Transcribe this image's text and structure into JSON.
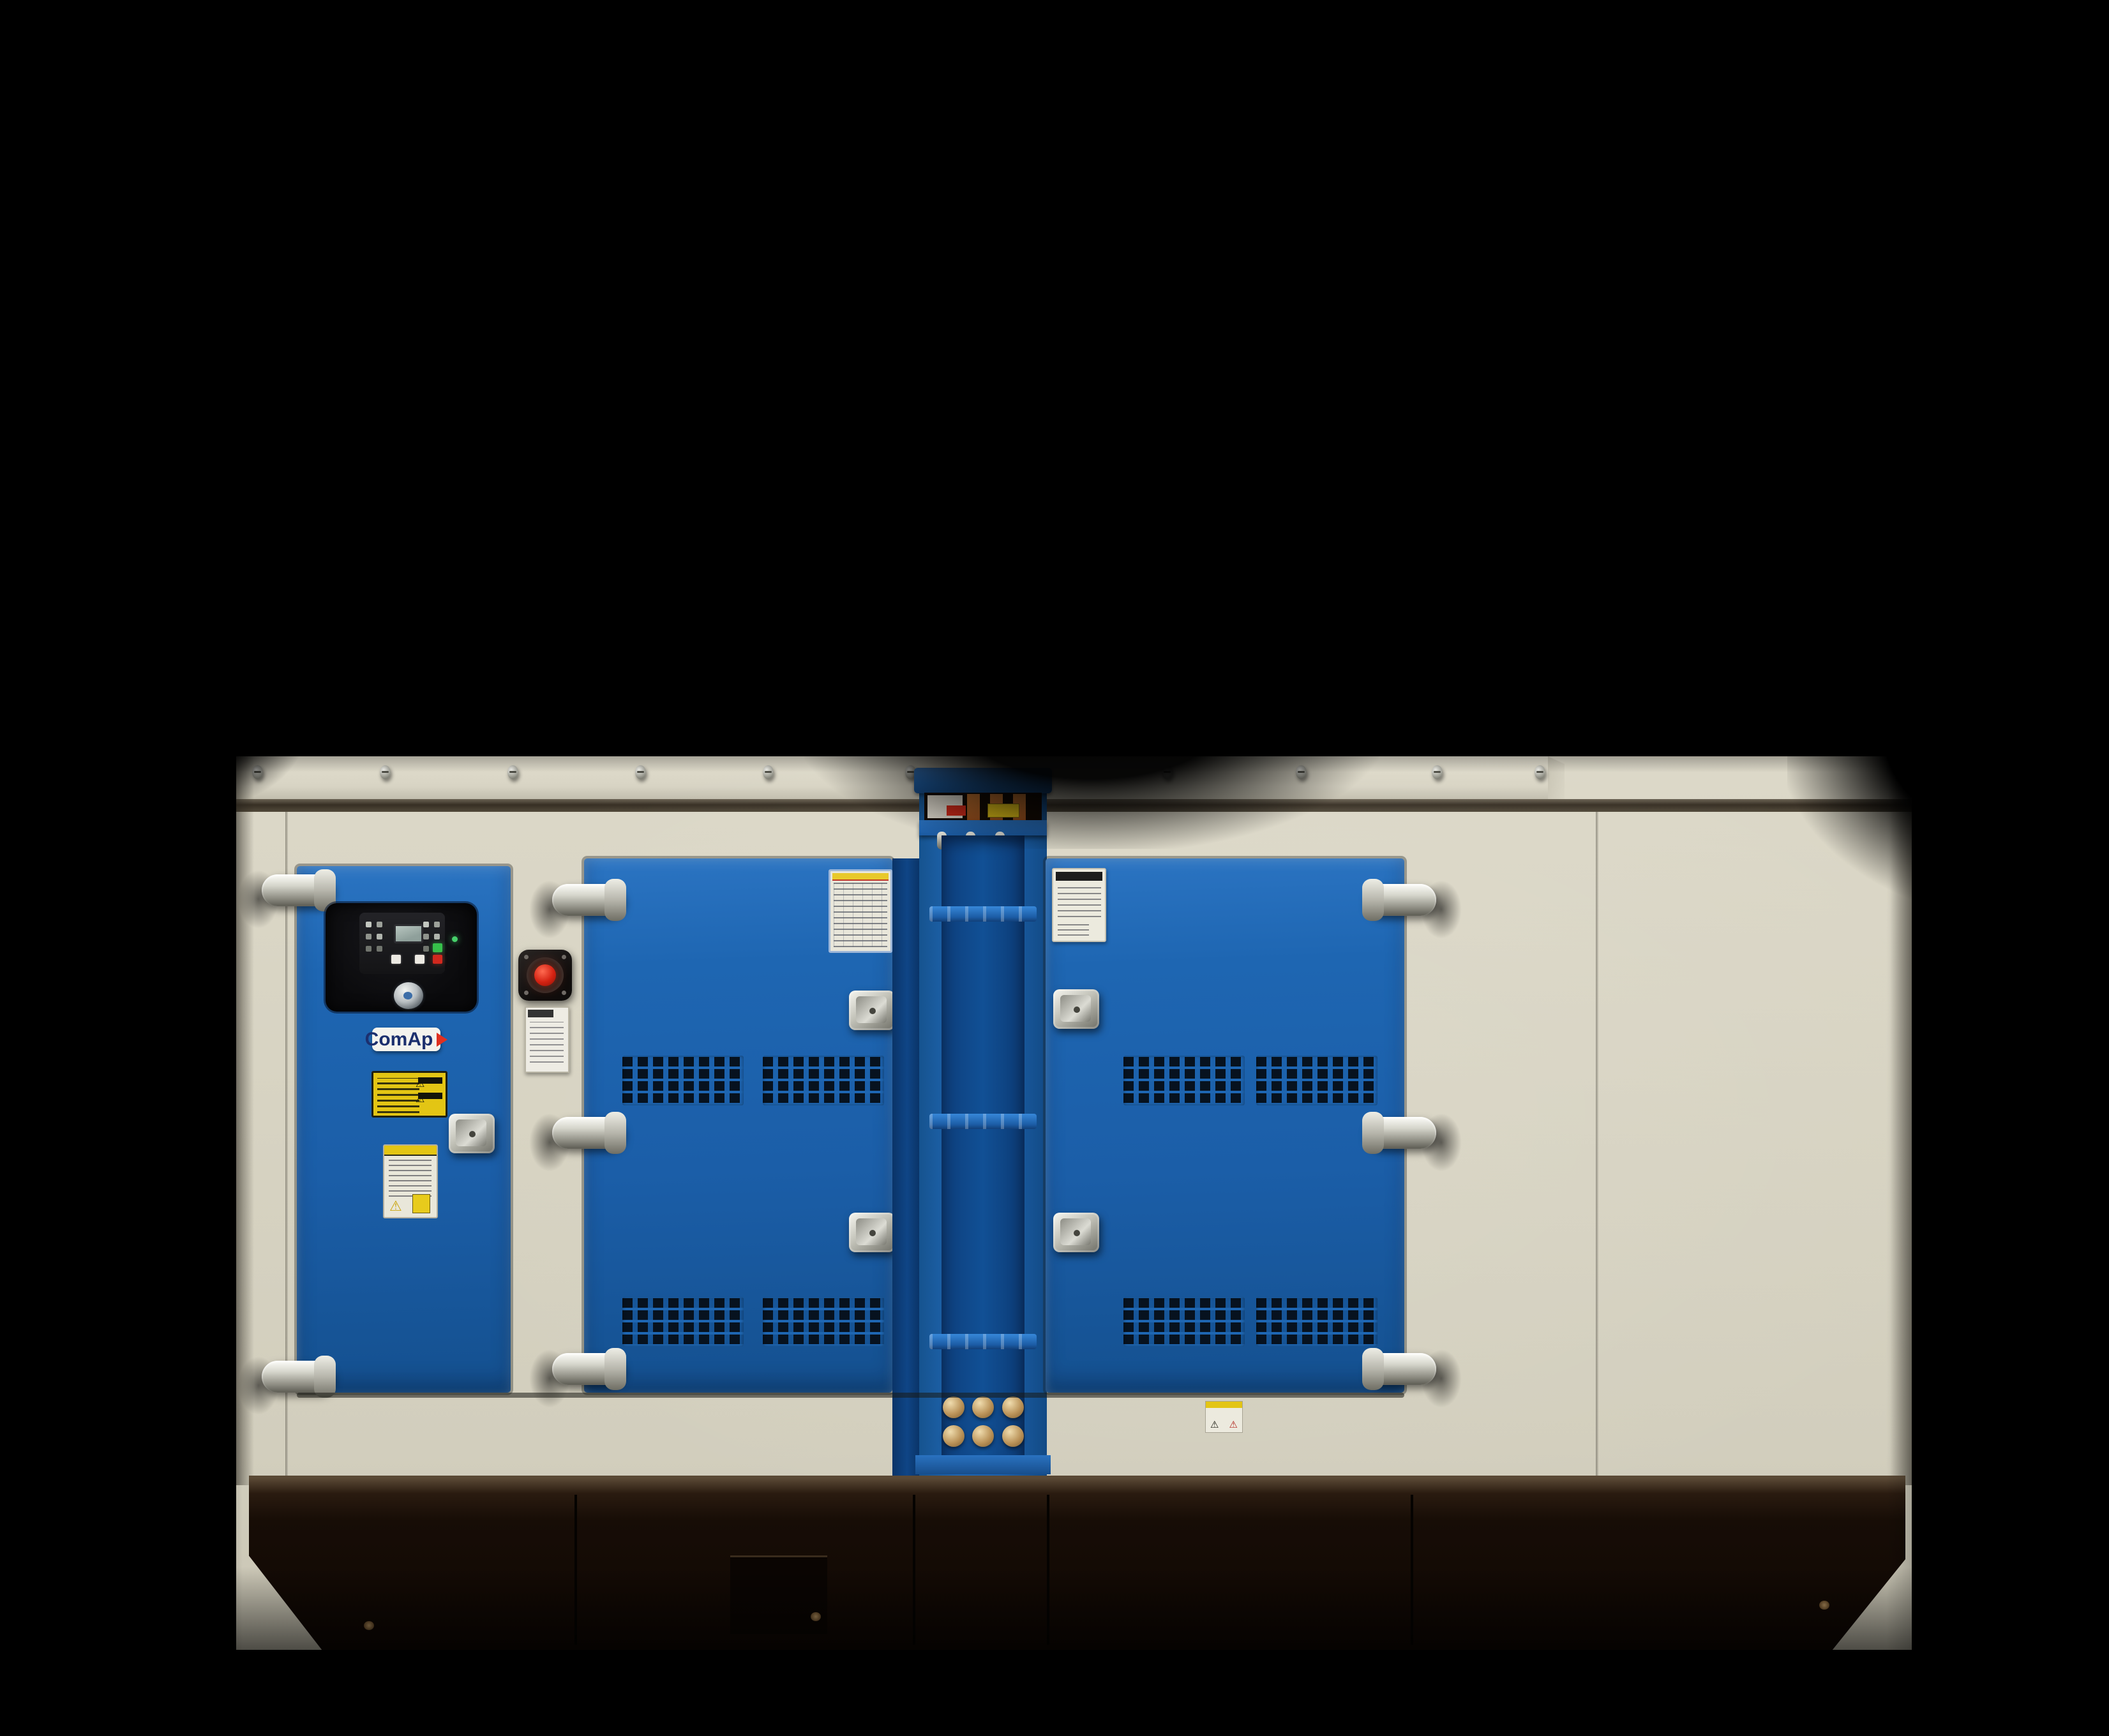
{
  "scene": {
    "subject": "Blue and beige diesel generator set in a soundproof canopy photographed on a black background",
    "background_color": "#000000"
  },
  "branding": {
    "controller_logo": "ComAp"
  },
  "icons": {
    "warning_triangle": "⚠"
  },
  "colors": {
    "door_blue": "#1e66b2",
    "panel_beige": "#d7d3c2",
    "base_dark_brown": "#170d06",
    "chrome": "#d6d6cc",
    "estop_red": "#d42212",
    "start_button_green": "#36c04a",
    "stop_button_red": "#d2281e",
    "busbar_copper": "#b4622a",
    "warning_label_yellow": "#e3c514",
    "terminal_bolt_brass": "#bb945a"
  }
}
